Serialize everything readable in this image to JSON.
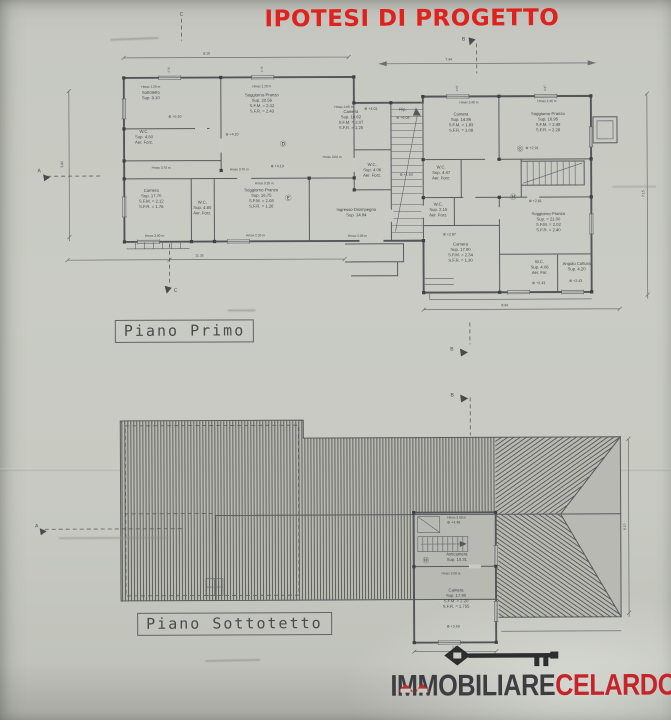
{
  "title": "IPOTESI DI PROGETTO",
  "plan_labels": {
    "primo": "Piano Primo",
    "sottotetto": "Piano Sottotetto"
  },
  "logo": {
    "word_dark": "IMMOBILIARE",
    "word_red": "CELARDO",
    "registered": "®"
  },
  "colors": {
    "title_red": "#df221d",
    "logo_dark": "#3d3d41",
    "logo_red": "#c5242b",
    "paper": "#c8cac3",
    "ink": "#46474b"
  },
  "annotations": [
    {
      "n": "room-label",
      "lines": [
        "Sottotetto",
        "Sup. 9.10"
      ],
      "x": 152,
      "y": 93
    },
    {
      "n": "room-label",
      "lines": [
        "W.C.",
        "Sup. 4.50",
        "Aer. Forz."
      ],
      "x": 145,
      "y": 132
    },
    {
      "n": "room-label",
      "lines": [
        "Camera",
        "Sup. 17.70",
        "S.F.M. = 2.12",
        "S.F.R. = 1.76"
      ],
      "x": 152,
      "y": 191
    },
    {
      "n": "room-label",
      "lines": [
        "W.C.",
        "Sup. 4.80",
        "Aer. Forz."
      ],
      "x": 203,
      "y": 203
    },
    {
      "n": "room-label",
      "lines": [
        "Soggiorno-Pranzo",
        "Sup. 20.56",
        "S.F.M. = 2.02",
        "S.F.R. = 2.43"
      ],
      "x": 263,
      "y": 96
    },
    {
      "n": "room-label",
      "lines": [
        "Soggiorno-Pranzo",
        "Sup. 16.75",
        "S.F.M. = 2.08",
        "S.F.R. = 1.26"
      ],
      "x": 262,
      "y": 191
    },
    {
      "n": "room-label",
      "lines": [
        "Camera",
        "Sup. 16.62",
        "S.F.M. = 2.07",
        "S.F.R. = 1.25"
      ],
      "x": 352,
      "y": 113
    },
    {
      "n": "room-label",
      "t": "Rip.",
      "x": 404,
      "y": 111
    },
    {
      "n": "room-label",
      "lines": [
        "Camera",
        "Sup. 14.86",
        "S.F.M. = 1.83",
        "S.F.R. = 1.08"
      ],
      "x": 462,
      "y": 116
    },
    {
      "n": "room-label",
      "lines": [
        "Soggiorno-Pranzo",
        "Sup. 16.95",
        "S.F.M. = 2.49",
        "S.F.R. = 2.28"
      ],
      "x": 549,
      "y": 116
    },
    {
      "n": "room-label",
      "lines": [
        "W.C.",
        "Sup. 4.06",
        "Aer. Forz."
      ],
      "x": 373,
      "y": 166
    },
    {
      "n": "room-label",
      "lines": [
        "W.C.",
        "Sup. 4.47",
        "Aer. Forz."
      ],
      "x": 442,
      "y": 169
    },
    {
      "n": "room-label",
      "lines": [
        "Ingresso-Disimpegno",
        "Sup. 14.94"
      ],
      "x": 357,
      "y": 211
    },
    {
      "n": "room-label",
      "lines": [
        "W.C.",
        "Sup. 2.15",
        "Aer. Forz."
      ],
      "x": 439,
      "y": 206
    },
    {
      "n": "room-label",
      "lines": [
        "Soggiorno-Pranzo",
        "Sup. = 21.00",
        "S.F.M. = 2.02",
        "S.F.R. = 2.40"
      ],
      "x": 549,
      "y": 216
    },
    {
      "n": "room-label",
      "lines": [
        "Camera",
        "Sup. 17.90",
        "S.F.M. = 2.34",
        "S.F.R. = 1.30"
      ],
      "x": 461,
      "y": 246
    },
    {
      "n": "room-label",
      "lines": [
        "W.C.",
        "Sup. 4.06",
        "Aer. For."
      ],
      "x": 540,
      "y": 264
    },
    {
      "n": "room-label",
      "lines": [
        "Angolo Cottura",
        "Sup. 4.20"
      ],
      "x": 577,
      "y": 266
    },
    {
      "n": "room-label",
      "lines": [
        "Anticamera",
        "Sup. 10.31"
      ],
      "x": 456,
      "y": 556
    },
    {
      "n": "room-label",
      "lines": [
        "Camera",
        "Sup. 17.90",
        "S.F.M. = 2.20",
        "S.F.R. = 1.755"
      ],
      "x": 455,
      "y": 592
    },
    {
      "n": "level-mark",
      "t": "⊕ +5.10",
      "x": 176,
      "y": 117,
      "s": 3.6
    },
    {
      "n": "level-mark",
      "t": "⊕ +4.10",
      "x": 233,
      "y": 135,
      "s": 3.6
    },
    {
      "n": "level-mark",
      "t": "⊕ +4.19",
      "x": 278,
      "y": 167,
      "s": 3.6
    },
    {
      "n": "level-mark",
      "t": "⊕ +4.01",
      "x": 372,
      "y": 110,
      "s": 3.6
    },
    {
      "n": "level-mark",
      "t": "⊕ +6.08",
      "x": 404,
      "y": 119,
      "s": 3.6
    },
    {
      "n": "level-mark",
      "t": "⊕ +1.63",
      "x": 407,
      "y": 176,
      "s": 3.6
    },
    {
      "n": "level-mark",
      "t": "⊕ +2.91",
      "x": 533,
      "y": 150,
      "s": 3.6
    },
    {
      "n": "level-mark",
      "t": "⊕ +2.81",
      "x": 536,
      "y": 203,
      "s": 3.6
    },
    {
      "n": "level-mark",
      "t": "⊕ +2.87",
      "x": 450,
      "y": 236,
      "s": 3.6
    },
    {
      "n": "level-mark",
      "t": "⊕ +2.43",
      "x": 539,
      "y": 285,
      "s": 3.6
    },
    {
      "n": "level-mark",
      "t": "⊕ +2.43",
      "x": 576,
      "y": 283,
      "s": 3.6
    },
    {
      "n": "level-mark",
      "t": "⊕ +4.48",
      "x": 453,
      "y": 524,
      "s": 3.6
    },
    {
      "n": "level-mark",
      "t": "⊕ +3.69",
      "x": 452,
      "y": 628,
      "s": 3.6
    },
    {
      "n": "unit-ref",
      "t": "Ⓓ",
      "x": 284,
      "y": 146,
      "s": 6.5
    },
    {
      "n": "unit-ref",
      "t": "Ⓔ",
      "x": 289,
      "y": 200,
      "s": 6.5
    },
    {
      "n": "unit-ref",
      "t": "Ⓖ",
      "x": 521,
      "y": 152,
      "s": 6.5
    },
    {
      "n": "unit-ref",
      "t": "Ⓗ",
      "x": 514,
      "y": 200,
      "s": 6.5
    },
    {
      "n": "unit-ref",
      "t": "Ⓗ",
      "x": 425,
      "y": 563,
      "s": 6.5
    },
    {
      "n": "hmax-label",
      "t": "Hmax  1.05 m",
      "x": 152,
      "y": 87,
      "s": 3.2
    },
    {
      "n": "hmax-label",
      "t": "Hmax  2.20 m",
      "x": 263,
      "y": 87,
      "s": 3.2
    },
    {
      "n": "hmax-label",
      "t": "Hmax  2.85 m",
      "x": 345,
      "y": 108,
      "s": 3.2
    },
    {
      "n": "hmax-label",
      "t": "Hmax  2.40 m",
      "x": 470,
      "y": 104,
      "s": 3.2
    },
    {
      "n": "hmax-label",
      "t": "Hmax  2.40 m",
      "x": 548,
      "y": 103,
      "s": 3.2
    },
    {
      "n": "hmax-label",
      "t": "Hmax  3.70 m",
      "x": 162,
      "y": 168,
      "s": 3.2
    },
    {
      "n": "hmax-label",
      "t": "Hmax  3.70 m",
      "x": 240,
      "y": 170,
      "s": 3.2
    },
    {
      "n": "hmax-label",
      "t": "Hmax  3.04 m",
      "x": 333,
      "y": 158,
      "s": 3.2
    },
    {
      "n": "hmax-label",
      "t": "Hmax  3.25 m",
      "x": 265,
      "y": 184,
      "s": 3.2
    },
    {
      "n": "hmax-label",
      "t": "Hmax  3.00 m",
      "x": 155,
      "y": 236,
      "s": 3.2
    },
    {
      "n": "hmax-label",
      "t": "Hmax  2.20 m",
      "x": 256,
      "y": 236,
      "s": 3.2
    },
    {
      "n": "hmax-label",
      "t": "Hmax  2.38 m",
      "x": 358,
      "y": 237,
      "s": 3.2
    },
    {
      "n": "hmax-label",
      "t": "Hmax  3.08 m",
      "x": 456,
      "y": 519,
      "s": 3.2
    },
    {
      "n": "hmax-label",
      "t": "Hmax  3.08 m",
      "x": 450,
      "y": 575,
      "s": 3.2
    },
    {
      "n": "dim-label",
      "t": "8.10",
      "x": 208,
      "y": 54,
      "s": 3.4
    },
    {
      "n": "dim-label",
      "t": "7.94",
      "x": 450,
      "y": 61,
      "s": 3.4
    },
    {
      "n": "dim-label",
      "t": "11.35",
      "x": 200,
      "y": 256,
      "s": 3.4
    },
    {
      "n": "dim-label",
      "t": "8.94",
      "x": 505,
      "y": 307,
      "s": 3.4
    },
    {
      "n": "dim-label",
      "t": "5.80",
      "x": 64,
      "y": 163,
      "s": 3.4,
      "rot": -90
    },
    {
      "n": "dim-label",
      "t": "7.15",
      "x": 645,
      "y": 195,
      "s": 3.4,
      "rot": -90
    },
    {
      "n": "dim-label",
      "t": "6.10",
      "x": 625,
      "y": 528,
      "s": 3.4,
      "rot": -90
    },
    {
      "n": "dim-label",
      "t": "3.08",
      "x": 454,
      "y": 649,
      "s": 3.4
    },
    {
      "n": "dim-label",
      "t": "2.70",
      "x": 171,
      "y": 69,
      "s": 2.8,
      "rot": -90
    },
    {
      "n": "dim-label",
      "t": "2.10",
      "x": 264,
      "y": 69,
      "s": 2.8,
      "rot": -90
    },
    {
      "n": "dim-label",
      "t": "2.60",
      "x": 459,
      "y": 89,
      "s": 2.8,
      "rot": -90
    },
    {
      "n": "dim-label",
      "t": "2.47",
      "x": 547,
      "y": 89,
      "s": 2.8,
      "rot": -90
    },
    {
      "n": "section-marker",
      "t": "C",
      "x": 183,
      "y": 15,
      "s": 5
    },
    {
      "n": "section-marker",
      "t": "C",
      "x": 176,
      "y": 291,
      "s": 5
    },
    {
      "n": "section-marker",
      "t": "B",
      "x": 465,
      "y": 41,
      "s": 5
    },
    {
      "n": "section-marker",
      "t": "B",
      "x": 452,
      "y": 351,
      "s": 5
    },
    {
      "n": "section-marker",
      "t": "B",
      "x": 452,
      "y": 397,
      "s": 5
    },
    {
      "n": "section-marker",
      "t": "A",
      "x": 40,
      "y": 171,
      "s": 5
    },
    {
      "n": "section-marker",
      "t": "A",
      "x": 36,
      "y": 526,
      "s": 5
    }
  ]
}
